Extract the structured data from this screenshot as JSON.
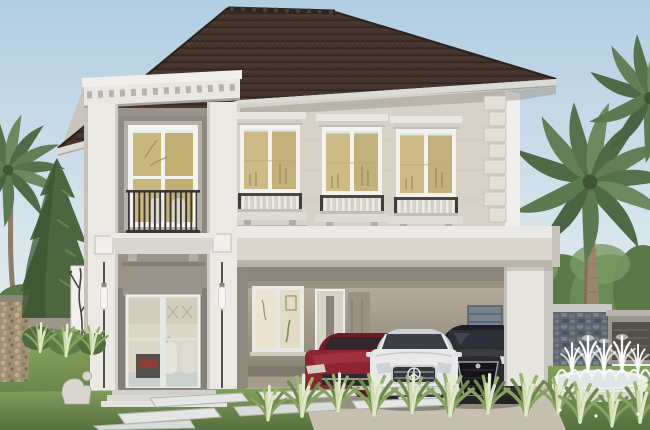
{
  "scene": {
    "type": "3d-architectural-rendering",
    "setting": "daytime exterior",
    "description": "Two-story modern classic house with a dark brown hip tile roof, cream and grey facade, dentil cornice, juliet balconies, tall glass entry with wall sconces, attached carport sheltering three cars, tropical landscaping with palm trees, conical topiary, stone feature walls and a round white fountain.",
    "house": {
      "floors": 2,
      "roof": "hip roof with dark brown tiles",
      "upper_windows": 3,
      "tower_window": "tall window with juliet balcony and planter sill",
      "entry": "full-height glass doors flanked by rod sconces",
      "carport_cars": 3
    },
    "cars": [
      {
        "position": "left",
        "color": "dark red",
        "body": "sedan"
      },
      {
        "position": "center",
        "color": "white",
        "body": "coupe",
        "emblem": "three-pointed star"
      },
      {
        "position": "right",
        "color": "black",
        "body": "suv"
      }
    ],
    "landscape": [
      "palm trees",
      "conical topiary tree",
      "hedges",
      "ornamental grasses",
      "stone pillar",
      "grey fence",
      "stone feature wall",
      "round white fountain with water jets",
      "stepping stone path",
      "lawn",
      "white branch-art screen panel",
      "garden statue"
    ]
  },
  "palette": {
    "sky_top": "#b2cde2",
    "sky_bottom": "#f1f4f4",
    "roof": "#44342c",
    "fascia": "#dbdad5",
    "cornice": "#e9e7e2",
    "wall_upper": "#d7d2c8",
    "tower_face": "#ebe9e4",
    "recess_gray": "#9a938a",
    "band": "#dbd7cf",
    "frame_gray": "#8e8981",
    "frame_white": "#f3f2ee",
    "glass_warm": "#ccbb87",
    "railing_dark": "#3a3836",
    "carport_white": "#e7e5e0",
    "interior_wall": "#ada496",
    "car_red": "#8e2430",
    "car_white": "#e9e9ea",
    "car_dark": "#2c2b2e",
    "grass": "#6f8e4f",
    "hedge": "#5a7849",
    "palm_green": "#647f57",
    "palm_trunk": "#98876c",
    "stone_wall": "#5c6570",
    "stone_pillar": "#a29072",
    "fence_gray": "#9b958c",
    "path_slab": "#e3e6e3",
    "fountain_white": "#f1f3ef",
    "screen_white": "#f1f0ec",
    "branch_dark": "#4a443d",
    "statue_white": "#d9d6cf"
  }
}
